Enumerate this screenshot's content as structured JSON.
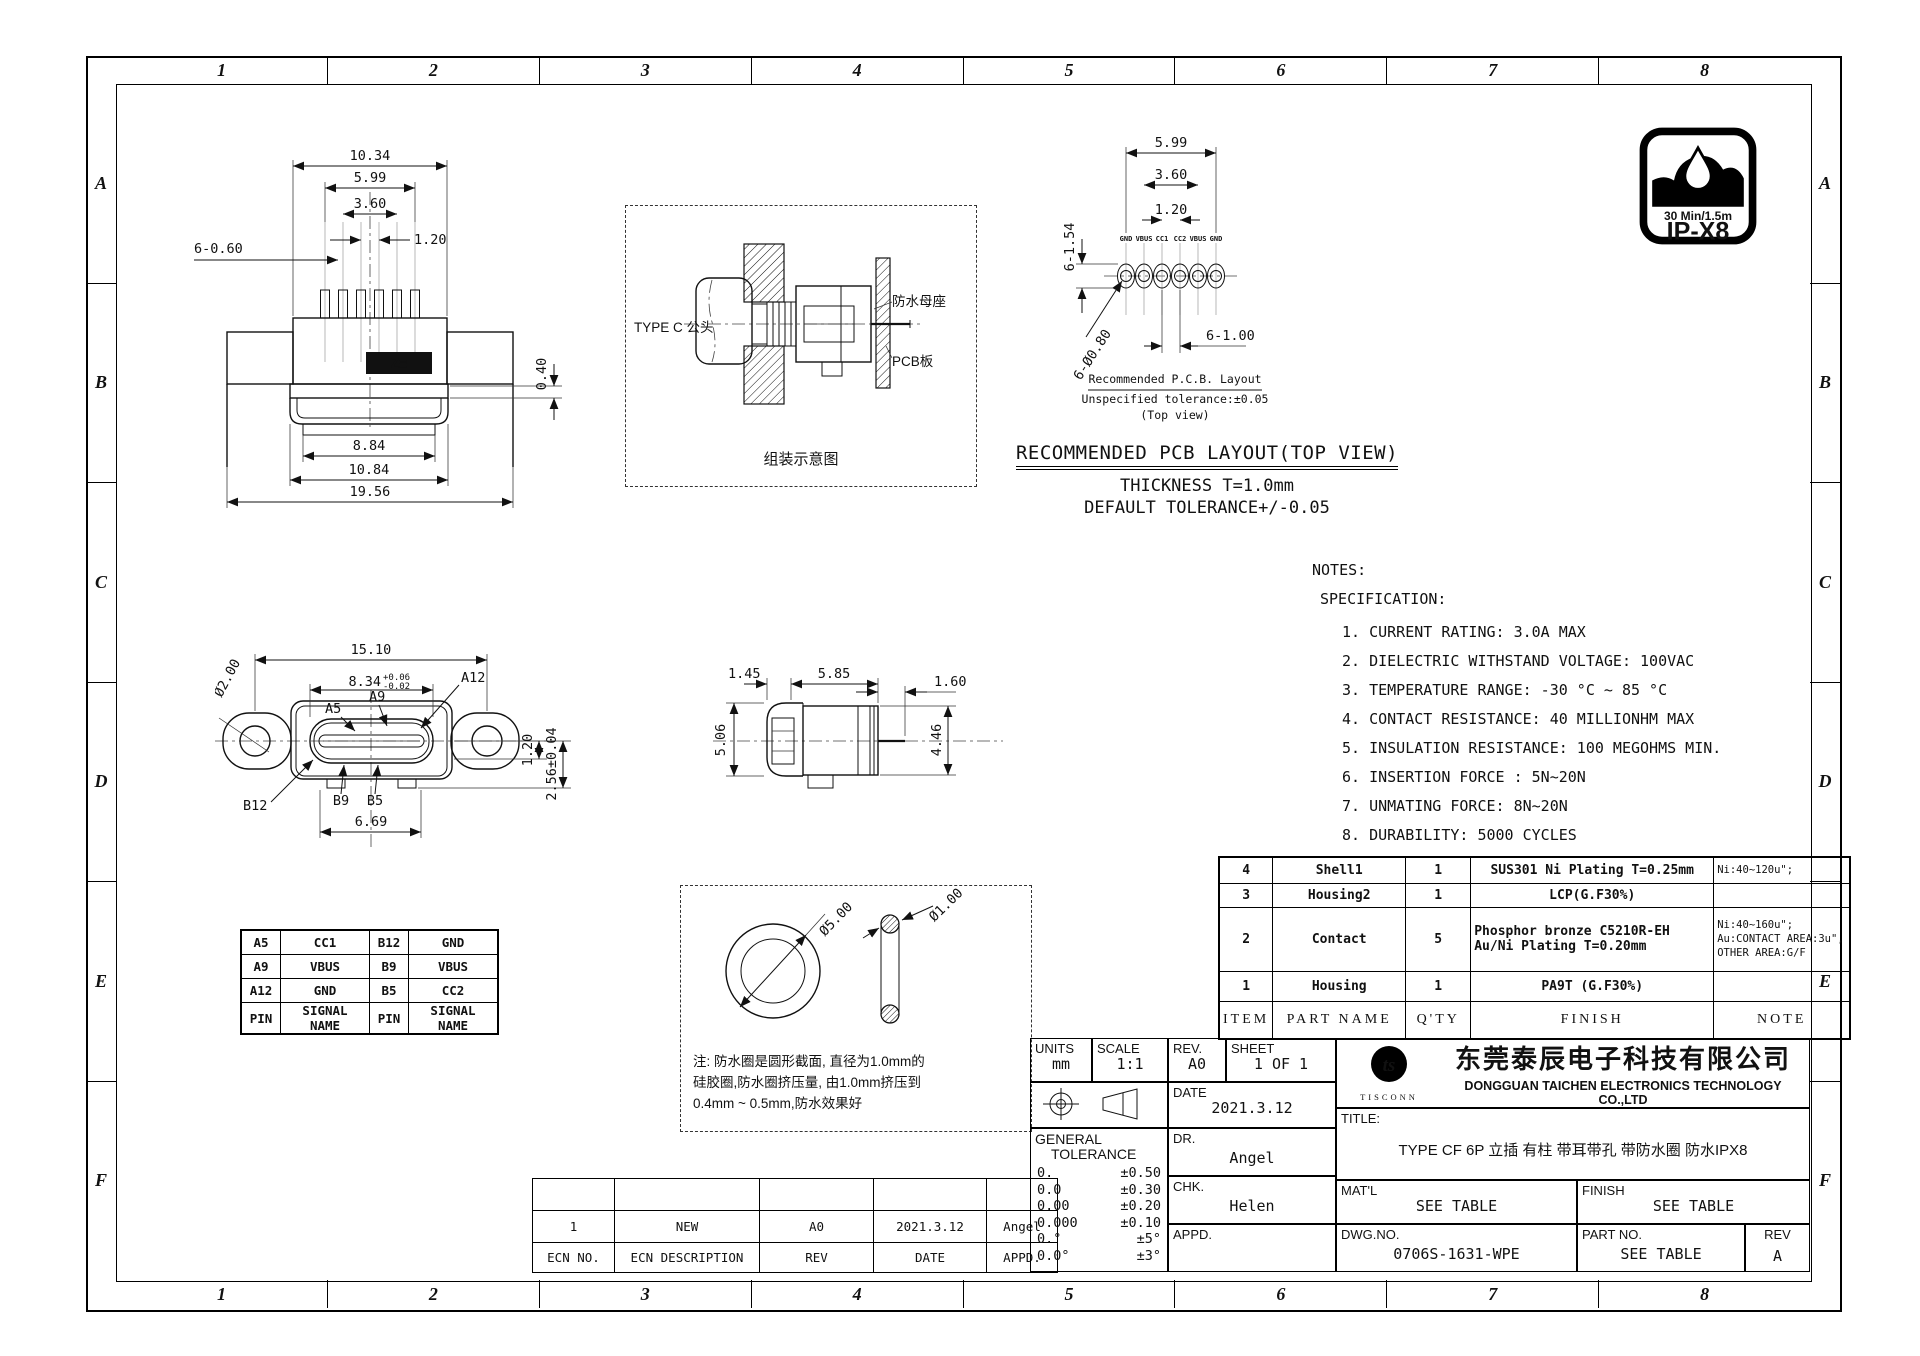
{
  "frame": {
    "columns": [
      "1",
      "2",
      "3",
      "4",
      "5",
      "6",
      "7",
      "8"
    ],
    "rows": [
      "A",
      "B",
      "C",
      "D",
      "E",
      "F"
    ]
  },
  "ip_badge": {
    "duration": "30 Min/1.5m",
    "rating": "IP-X8"
  },
  "front_top_view": {
    "marking": "Z≡",
    "dims": {
      "w_outer": "10.34",
      "w_pins": "5.99",
      "w_mid": "3.60",
      "pitch": "1.20",
      "pin_note": "6-0.60",
      "step": "0.40",
      "nose_inner": "8.84",
      "nose_outer": "10.84",
      "flange": "19.56"
    }
  },
  "assembly_view": {
    "plug_label": "TYPE C 公头",
    "receptacle_label": "防水母座",
    "pcb_label": "PCB板",
    "caption": "组装示意图"
  },
  "pcb_layout_view": {
    "dims": {
      "span": "5.99",
      "mid": "3.60",
      "pitch": "1.20",
      "pad": "6-1.54",
      "hole": "6-Ø0.80",
      "drill": "6-1.00"
    },
    "pads": [
      "GND",
      "VBUS",
      "CC1",
      "CC2",
      "VBUS",
      "GND"
    ],
    "caption1": "Recommended P.C.B. Layout",
    "caption2": "Unspecified tolerance:±0.05",
    "caption3": "(Top view)"
  },
  "pcb_heading": {
    "line1": "RECOMMENDED PCB LAYOUT(TOP VIEW)",
    "line2": "THICKNESS T=1.0mm",
    "line3": "DEFAULT TOLERANCE+/-0.05"
  },
  "notes": {
    "title": "NOTES:",
    "subtitle": "SPECIFICATION:",
    "items": [
      "1. CURRENT RATING: 3.0A MAX",
      "2. DIELECTRIC WITHSTAND VOLTAGE: 100VAC",
      "3. TEMPERATURE RANGE: -30 °C ~ 85 °C",
      "4. CONTACT RESISTANCE: 40 MILLIONHM MAX",
      "5. INSULATION RESISTANCE: 100 MEGOHMS MIN.",
      "6. INSERTION FORCE : 5N~20N",
      "7. UNMATING FORCE: 8N~20N",
      "8. DURABILITY: 5000 CYCLES"
    ]
  },
  "front_view": {
    "dims": {
      "width": "15.10",
      "slot": "8.34",
      "tol_up": "+0.06",
      "tol_dn": "-0.02",
      "ear_hole": "Ø2.00",
      "feet": "6.69",
      "offset": "1.20",
      "height": "2.56±0.04"
    },
    "pins": {
      "a12": "A12",
      "a5": "A5",
      "a9": "A9",
      "b12": "B12",
      "b9": "B9",
      "b5": "B5"
    }
  },
  "side_view": {
    "dims": {
      "cap": "1.45",
      "body": "5.85",
      "pin": "1.60",
      "cap_h": "5.06",
      "body_h": "4.46"
    }
  },
  "pin_table": {
    "rows": [
      [
        "A5",
        "CC1",
        "B12",
        "GND"
      ],
      [
        "A9",
        "VBUS",
        "B9",
        "VBUS"
      ],
      [
        "A12",
        "GND",
        "B5",
        "CC2"
      ],
      [
        "PIN",
        "SIGNAL NAME",
        "PIN",
        "SIGNAL NAME"
      ]
    ]
  },
  "oring_detail": {
    "outer_dia": "Ø5.00",
    "cross_dia": "Ø1.00",
    "note1": "注: 防水圈是圆形截面, 直径为1.0mm的",
    "note2": "硅胶圈,防水圈挤压量, 由1.0mm挤压到",
    "note3": "0.4mm ~ 0.5mm,防水效果好"
  },
  "bom": {
    "headers": [
      "ITEM",
      "PART  NAME",
      "Q'TY",
      "FINISH",
      "NOTE"
    ],
    "row4": {
      "item": "4",
      "part": "Shell1",
      "qty": "1",
      "finish": "SUS301 Ni  Plating T=0.25mm",
      "note": "Ni:40~120u\";"
    },
    "row3": {
      "item": "3",
      "part": "Housing2",
      "qty": "1",
      "finish": "LCP(G.F30%)",
      "note": ""
    },
    "row2": {
      "item": "2",
      "part": "Contact",
      "qty": "5",
      "finish1": "Phosphor bronze C5210R-EH",
      "finish2": "Au/Ni  Plating  T=0.20mm",
      "note1": "Ni:40~160u\";",
      "note2": "Au:CONTACT AREA:3u\",",
      "note3": "OTHER AREA:G/F"
    },
    "row1": {
      "item": "1",
      "part": "Housing",
      "qty": "1",
      "finish": "PA9T (G.F30%)",
      "note": ""
    }
  },
  "ecn": {
    "headers": [
      "ECN NO.",
      "ECN  DESCRIPTION",
      "REV",
      "DATE",
      "APPD."
    ],
    "entry": [
      "1",
      "NEW",
      "A0",
      "2021.3.12",
      "Angel"
    ],
    "empty": [
      "",
      "",
      "",
      "",
      ""
    ]
  },
  "title_block": {
    "units_label": "UNITS",
    "units": "mm",
    "scale_label": "SCALE",
    "scale": "1:1",
    "rev_label": "REV.",
    "rev": "A0",
    "sheet_label": "SHEET",
    "sheet": "1 OF 1",
    "date_label": "DATE",
    "date": "2021.3.12",
    "dr_label": "DR.",
    "dr": "Angel",
    "chk_label": "CHK.",
    "chk": "Helen",
    "appd_label": "APPD.",
    "appd": "",
    "tol_title1": "GENERAL",
    "tol_title2": "TOLERANCE",
    "tolerances": [
      [
        "0.",
        "±0.50"
      ],
      [
        "0.0",
        "±0.30"
      ],
      [
        "0.00",
        "±0.20"
      ],
      [
        "0.000",
        "±0.10"
      ],
      [
        "0.°",
        "±5°"
      ],
      [
        "0.0°",
        "±3°"
      ]
    ],
    "title_label": "TITLE:",
    "title": "TYPE CF 6P 立插 有柱 带耳带孔 带防水圈 防水IPX8",
    "matl_label": "MAT'L",
    "matl": "SEE TABLE",
    "finish_label": "FINISH",
    "finish": "SEE TABLE",
    "dwg_label": "DWG.NO.",
    "dwg": "0706S-1631-WPE",
    "part_label": "PART NO.",
    "part": "SEE TABLE",
    "rev2_label": "REV",
    "rev2": "A",
    "company_cn": "东莞泰辰电子科技有限公司",
    "company_en": "DONGGUAN TAICHEN ELECTRONICS TECHNOLOGY CO.,LTD",
    "logo_text": "TISCONN",
    "logo_short": "ts"
  }
}
